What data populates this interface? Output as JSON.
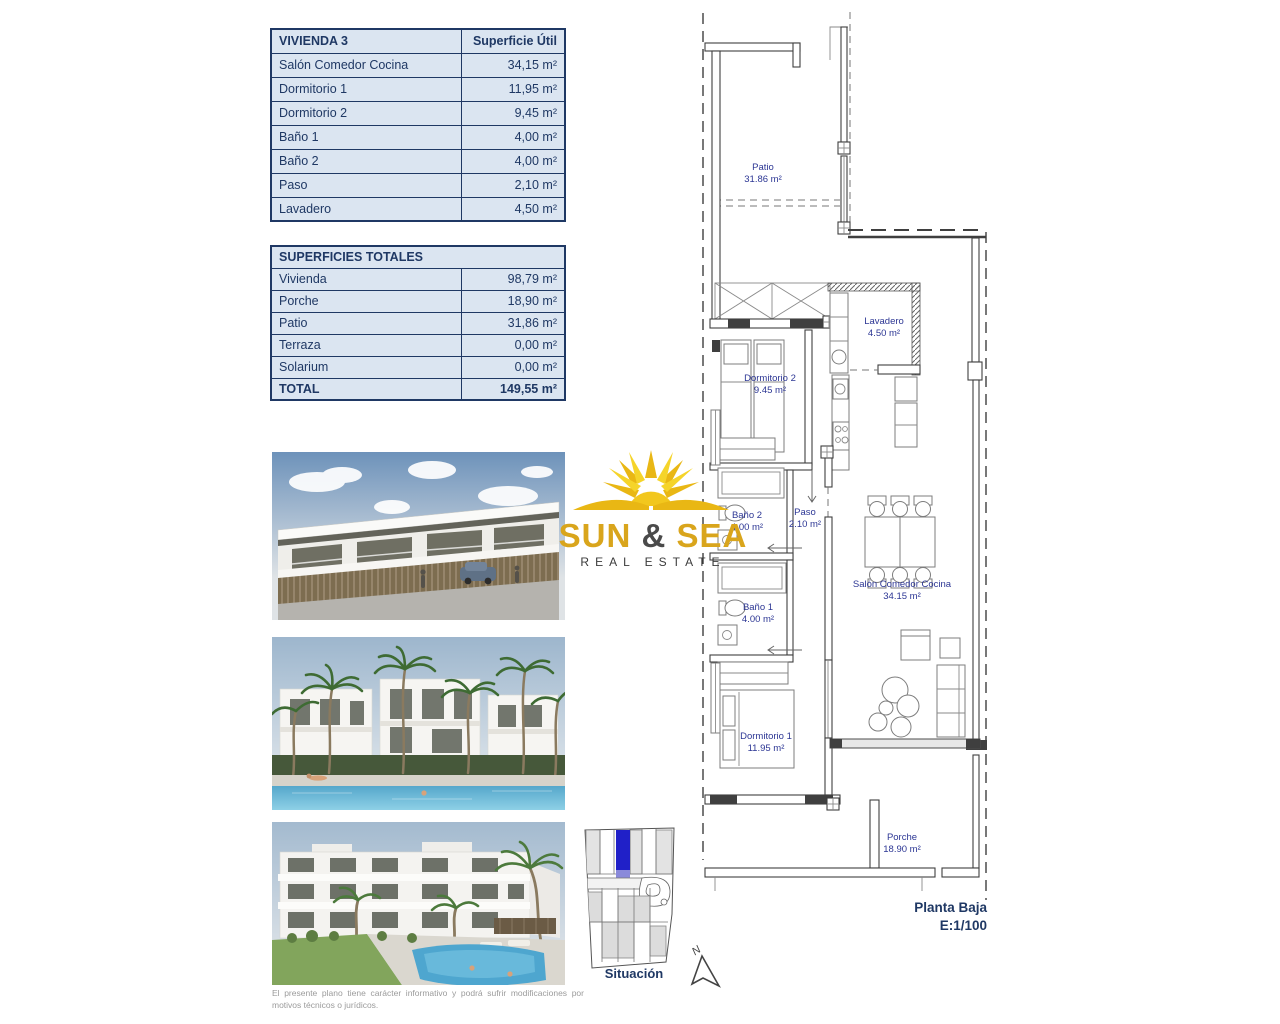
{
  "tables": {
    "vivienda": {
      "title": "VIVIENDA 3",
      "header": "Superficie Útil",
      "rows": [
        {
          "label": "Salón Comedor Cocina",
          "value": "34,15 m²"
        },
        {
          "label": "Dormitorio 1",
          "value": "11,95 m²"
        },
        {
          "label": "Dormitorio 2",
          "value": "9,45 m²"
        },
        {
          "label": "Baño 1",
          "value": "4,00 m²"
        },
        {
          "label": "Baño 2",
          "value": "4,00 m²"
        },
        {
          "label": "Paso",
          "value": "2,10 m²"
        },
        {
          "label": "Lavadero",
          "value": "4,50 m²"
        }
      ]
    },
    "totales": {
      "title": "SUPERFICIES TOTALES",
      "rows": [
        {
          "label": "Vivienda",
          "value": "98,79 m²"
        },
        {
          "label": "Porche",
          "value": "18,90 m²"
        },
        {
          "label": "Patio",
          "value": "31,86 m²"
        },
        {
          "label": "Terraza",
          "value": "0,00 m²"
        },
        {
          "label": "Solarium",
          "value": "0,00 m²"
        },
        {
          "label": "TOTAL",
          "value": "149,55 m²"
        }
      ]
    }
  },
  "logo": {
    "word1": "SUN",
    "amp": "&",
    "word2": "SEA",
    "tagline": "REAL ESTATE",
    "gold": "#d9a51c"
  },
  "plan": {
    "rooms": {
      "patio": {
        "name": "Patio",
        "area": "31.86 m²"
      },
      "lavadero": {
        "name": "Lavadero",
        "area": "4.50 m²"
      },
      "dormitorio2": {
        "name": "Dormitorio 2",
        "area": "9.45 m²"
      },
      "bano2": {
        "name": "Baño 2",
        "area": "4.00 m²"
      },
      "paso": {
        "name": "Paso",
        "area": "2.10 m²"
      },
      "bano1": {
        "name": "Baño 1",
        "area": "4.00 m²"
      },
      "salon": {
        "name": "Salón Comedor Cocina",
        "area": "34.15 m²"
      },
      "dormitorio1": {
        "name": "Dormitorio 1",
        "area": "11.95 m²"
      },
      "porche": {
        "name": "Porche",
        "area": "18.90 m²"
      }
    },
    "title": {
      "line1": "Planta Baja",
      "line2": "E:1/100"
    },
    "north_label": "N"
  },
  "situation": {
    "label": "Situación",
    "highlight_color": "#2020c8"
  },
  "document": {
    "disclaimer": "El presente plano tiene carácter informativo y podrá sufrir modificaciones por motivos técnicos o jurídicos."
  }
}
